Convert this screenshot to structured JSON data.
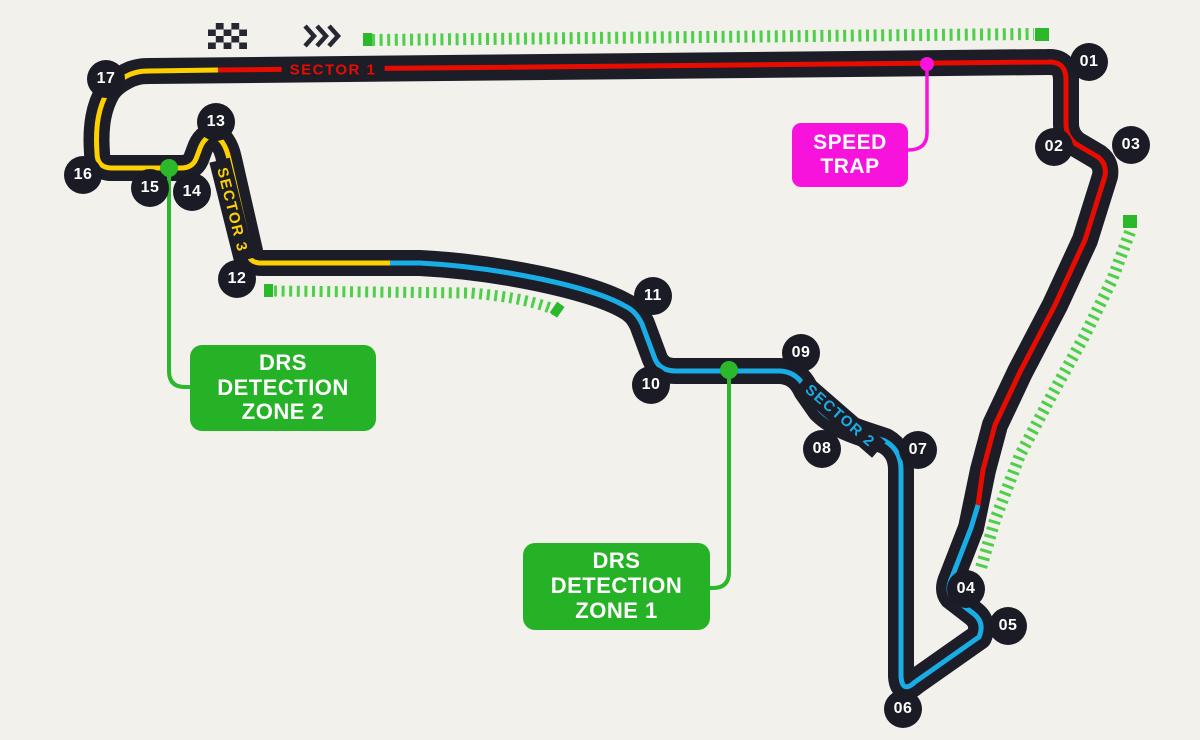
{
  "colors": {
    "background": "#f2f1ec",
    "track": "#1d1d28",
    "sector1_red": "#e80c00",
    "sector2_blue": "#19ade6",
    "sector3_yellow": "#fdd000",
    "drs_label_green": "#26b226",
    "drs_dash_green": "#4ecf4a",
    "drs_dot_green": "#2bb82b",
    "speed_trap_magenta": "#f813dc",
    "marker_circle": "#1b1b26",
    "marker_text": "#ffffff"
  },
  "sectors": [
    {
      "id": 1,
      "label": "SECTOR 1",
      "color": "#e80c00"
    },
    {
      "id": 2,
      "label": "SECTOR 2",
      "color": "#19ade6"
    },
    {
      "id": 3,
      "label": "SECTOR 3",
      "color": "#fdd000"
    }
  ],
  "corners": [
    {
      "label": "01"
    },
    {
      "label": "02"
    },
    {
      "label": "03"
    },
    {
      "label": "04"
    },
    {
      "label": "05"
    },
    {
      "label": "06"
    },
    {
      "label": "07"
    },
    {
      "label": "08"
    },
    {
      "label": "09"
    },
    {
      "label": "10"
    },
    {
      "label": "11"
    },
    {
      "label": "12"
    },
    {
      "label": "13"
    },
    {
      "label": "14"
    },
    {
      "label": "15"
    },
    {
      "label": "16"
    },
    {
      "label": "17"
    }
  ],
  "annotations": {
    "speed_trap": {
      "lines": [
        "SPEED",
        "TRAP"
      ]
    },
    "drs_detection_zone_1": {
      "lines": [
        "DRS",
        "DETECTION",
        "ZONE 1"
      ]
    },
    "drs_detection_zone_2": {
      "lines": [
        "DRS",
        "DETECTION",
        "ZONE 2"
      ]
    }
  },
  "icons": {
    "start_finish": "checkered-flag-icon",
    "race_direction": "triple-chevron-right-icon"
  }
}
